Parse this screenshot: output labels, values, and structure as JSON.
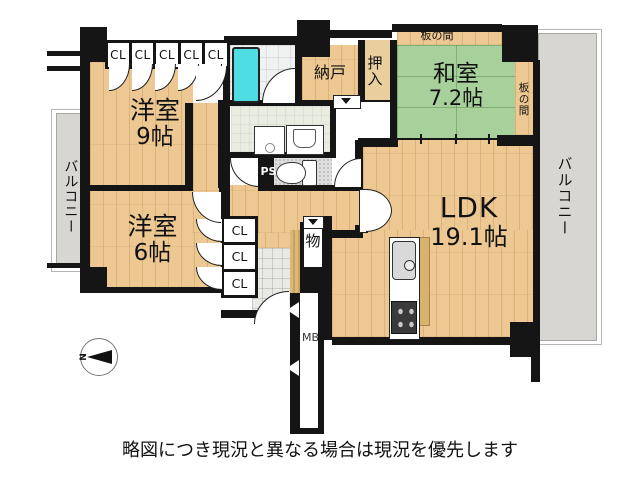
{
  "rooms": {
    "western9": {
      "name": "洋室",
      "size": "9帖"
    },
    "western6": {
      "name": "洋室",
      "size": "6帖"
    },
    "japanese": {
      "name": "和室",
      "size": "7.2帖"
    },
    "ldk": {
      "name": "LDK",
      "size": "19.1帖"
    }
  },
  "areas": {
    "nando": "納戸",
    "oshiire": "押入",
    "itanoma_top": "板の間",
    "itanoma_side": "板の間",
    "balcony_left": "バルコニー",
    "balcony_right": "バルコニー",
    "mono": "物",
    "pipe_space": "PS",
    "meter_box": "MB"
  },
  "closets_top": [
    "CL",
    "CL",
    "CL",
    "CL",
    "CL"
  ],
  "closets_side": [
    "CL",
    "CL",
    "CL"
  ],
  "compass": {
    "north": "N"
  },
  "caption": "略図につき現況と異なる場合は現況を優先します",
  "colors": {
    "wall": "#151515",
    "wood": "#edc893",
    "tatami": "#a8d09a",
    "balcony": "#d7d6d2",
    "bathtub": "#4fdde4"
  }
}
